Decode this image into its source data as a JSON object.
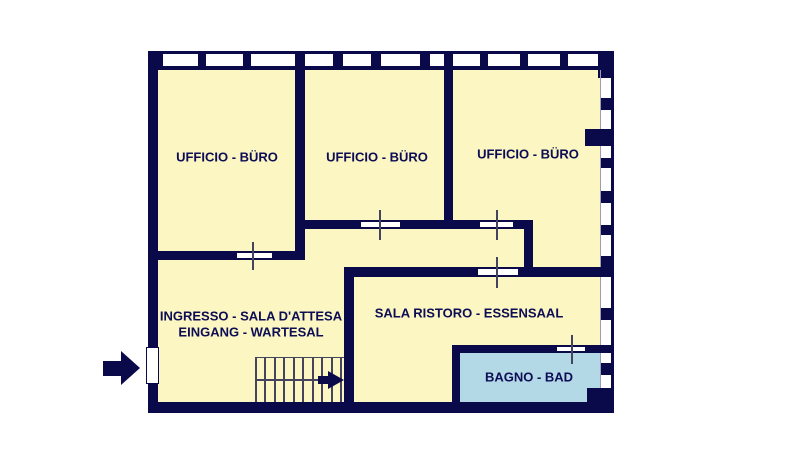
{
  "rooms": {
    "office1": {
      "label": "UFFICIO - BÜRO"
    },
    "office2": {
      "label": "UFFICIO - BÜRO"
    },
    "office3": {
      "label": "UFFICIO - BÜRO"
    },
    "entrance": {
      "label_it": "INGRESSO - SALA D'ATTESA",
      "label_de": "EINGANG - WARTESAL"
    },
    "break_room": {
      "label": "SALA RISTORO - ESSENSAAL"
    },
    "bathroom": {
      "label": "BAGNO - BAD"
    }
  },
  "colors": {
    "wall": "#0a0a4b",
    "room_fill": "#fbf6c2",
    "bathroom_fill": "#b4d9e6",
    "label_text": "#0d0d55",
    "tick": "#44445f",
    "window": "#ffffff",
    "background": "#ffffff"
  }
}
